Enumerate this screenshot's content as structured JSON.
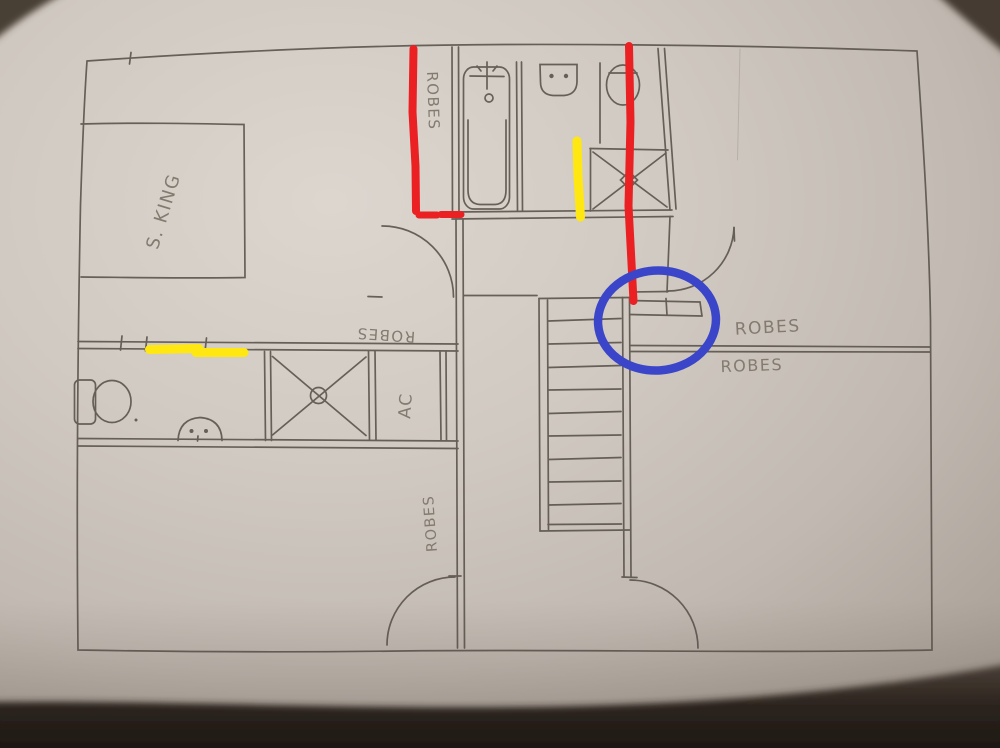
{
  "plan": {
    "bed_label": "S. KING",
    "ensuite_robe_label": "ROBES",
    "hall_robe_label": "ROBES",
    "ac_label": "AC",
    "lower_room_robe_label": "ROBES",
    "right_room_robe_label_upper": "ROBES",
    "right_room_robe_label_lower": "ROBES"
  },
  "annotations": {
    "red_hex": "#ea2023",
    "yellow_hex": "#ffe712",
    "blue_hex": "#3b45c9",
    "pencil_hex": "#57514a"
  }
}
